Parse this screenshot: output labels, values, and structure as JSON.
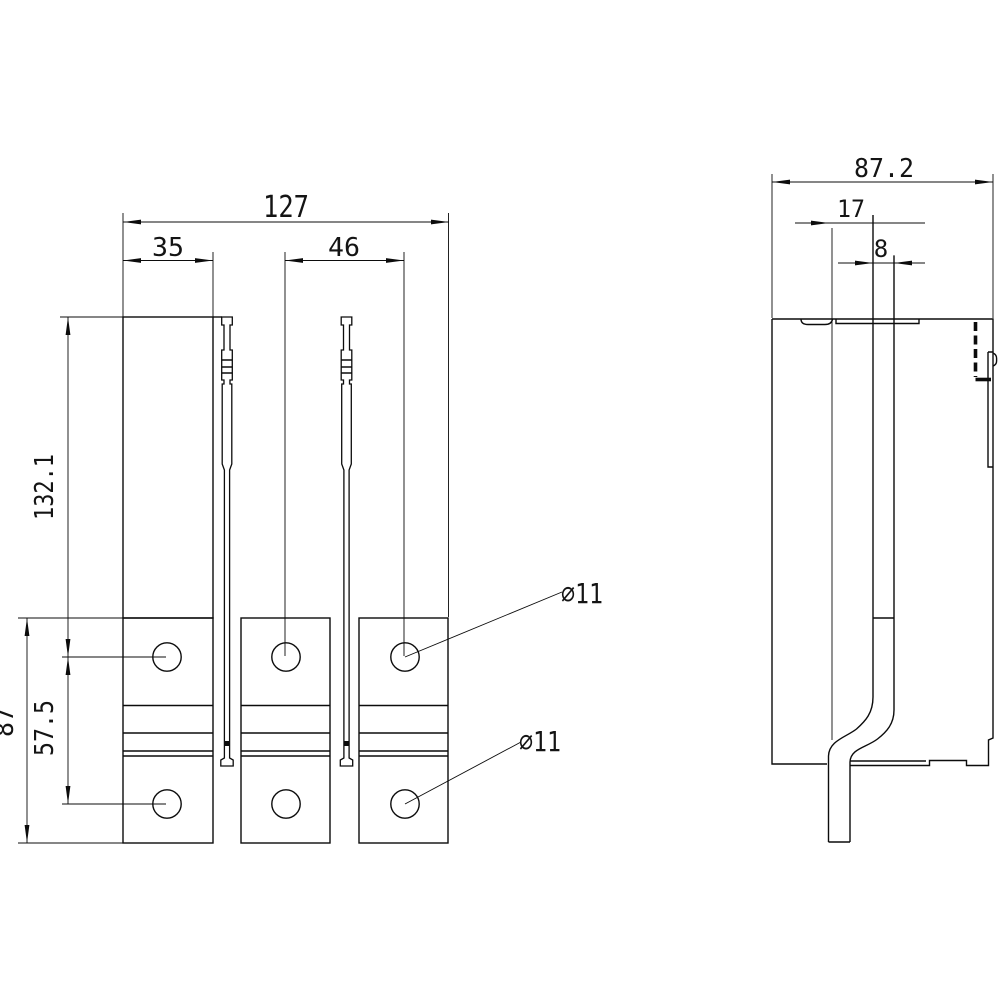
{
  "drawing": {
    "background": "#ffffff",
    "line_color": "#0c0c0c",
    "front_view": {
      "dim_overall_width": "127",
      "dim_pole_width": "35",
      "dim_pole_pitch": "46",
      "dim_top_to_upper_hole": "132.1",
      "dim_hole_spacing": "57.5",
      "dim_block_height": "87",
      "label_upper_holes": "⌀11",
      "label_lower_holes": "⌀11"
    },
    "side_view": {
      "dim_overall_depth": "87.2",
      "dim_blade_offset": "17",
      "dim_blade_thickness": "8"
    }
  }
}
